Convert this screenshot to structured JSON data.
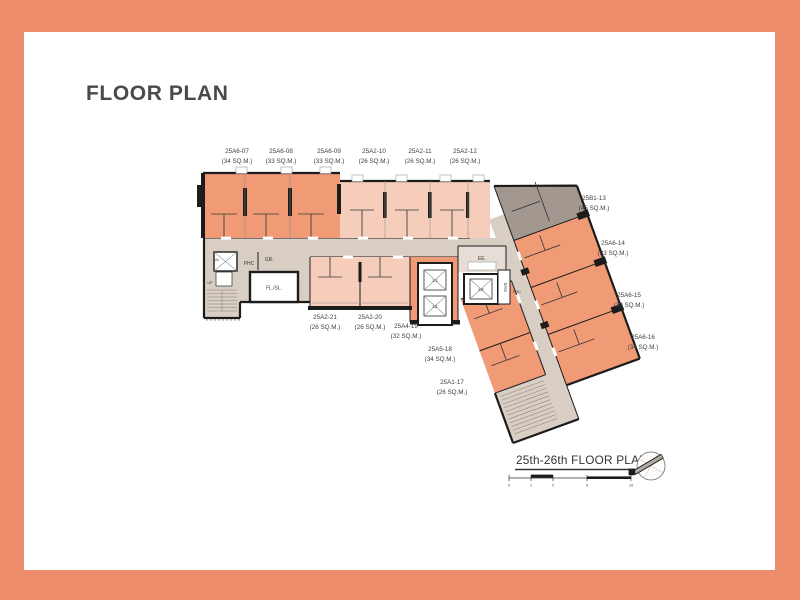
{
  "title": "FLOOR PLAN",
  "caption": {
    "text": "25th-26th FLOOR PLAN"
  },
  "scale_bar": {
    "ticks": [
      "0",
      "1",
      "2",
      "5",
      "10"
    ]
  },
  "units": {
    "top": [
      {
        "id": "25A6-07",
        "area": "(34 SQ.M.)"
      },
      {
        "id": "25A6-08",
        "area": "(33 SQ.M.)"
      },
      {
        "id": "25A6-09",
        "area": "(33 SQ.M.)"
      },
      {
        "id": "25A2-10",
        "area": "(26 SQ.M.)"
      },
      {
        "id": "25A2-11",
        "area": "(26 SQ.M.)"
      },
      {
        "id": "25A2-12",
        "area": "(26 SQ.M.)"
      }
    ],
    "right": [
      {
        "id": "25B1-13",
        "area": "(45 SQ.M.)"
      },
      {
        "id": "25A6-14",
        "area": "(33 SQ.M.)"
      },
      {
        "id": "25A6-15",
        "area": "(33 SQ.M.)"
      },
      {
        "id": "25A6-16",
        "area": "(34 SQ.M.)"
      }
    ],
    "bottom": [
      {
        "id": "25A2-21",
        "area": "(26 SQ.M.)"
      },
      {
        "id": "25A2-20",
        "area": "(26 SQ.M.)"
      },
      {
        "id": "25A4-19",
        "area": "(32 SQ.M.)"
      },
      {
        "id": "25A5-18",
        "area": "(34 SQ.M.)"
      },
      {
        "id": "25A1-17",
        "area": "(26 SQ.M.)"
      }
    ]
  },
  "core": {
    "phc": "PHC",
    "gb": "GB.",
    "fl_sl": "FL./SL.",
    "dn": "DN",
    "up": "UP",
    "ee": "EE.",
    "san": "SAN",
    "phc_small": "PHC",
    "l1": "L1",
    "l2": "L2",
    "l3": "L3"
  },
  "colors": {
    "unit_salmon": "#F09A76",
    "unit_light": "#F5CDBA",
    "unit_gray": "#A29890",
    "corridor_taupe": "#D8CEC4",
    "wall": "#1c1c1c",
    "text": "#3f3f3f",
    "border_coral": "#EE8D6C"
  }
}
